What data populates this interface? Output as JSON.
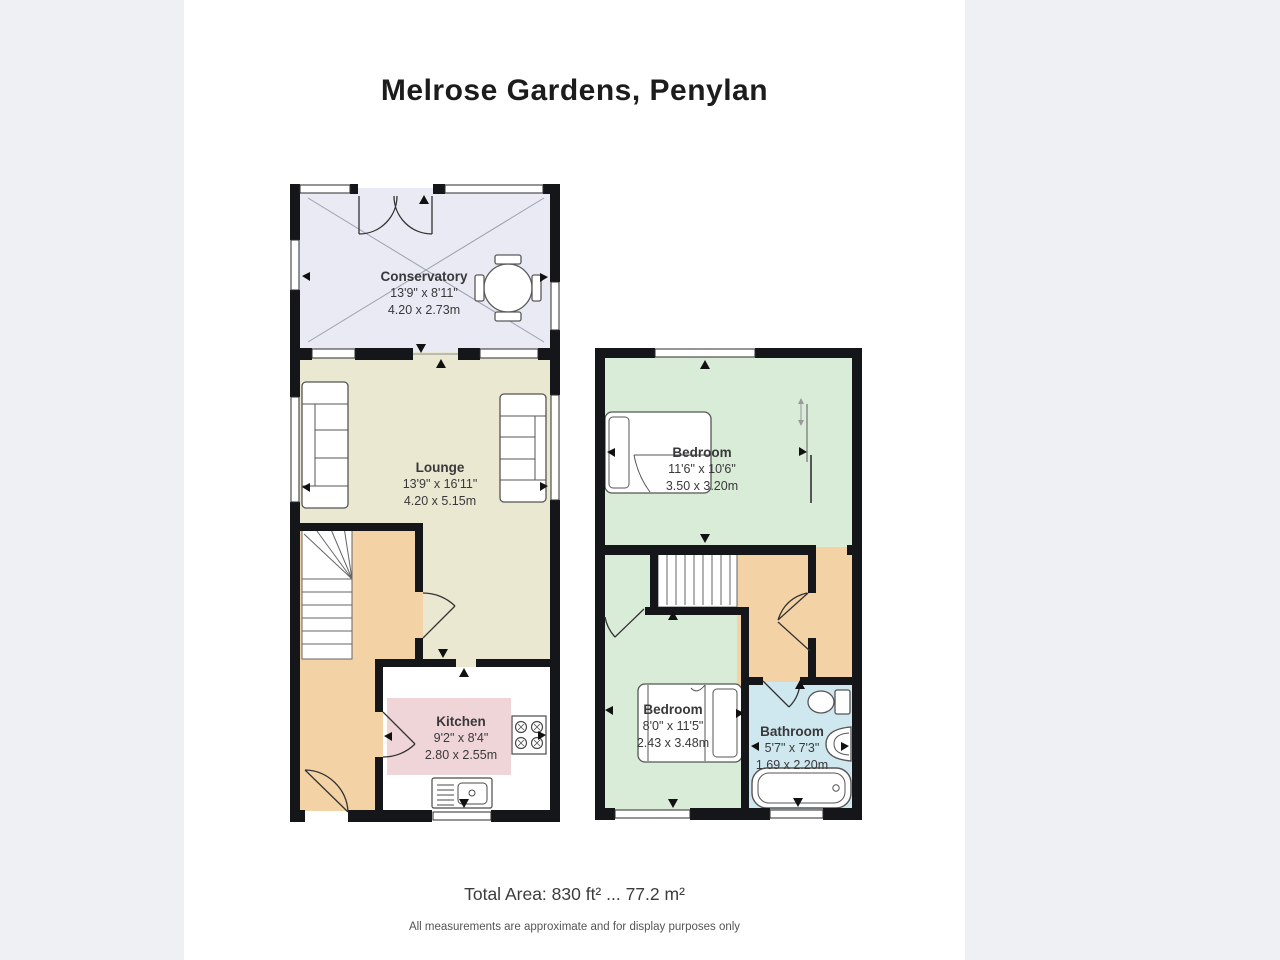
{
  "title": "Melrose Gardens, Penylan",
  "footer": {
    "total_area": "Total Area: 830 ft² ... 77.2 m²",
    "disclaimer": "All measurements are approximate and for display purposes only"
  },
  "floors": {
    "ground": {
      "rooms": {
        "conservatory": {
          "name": "Conservatory",
          "imperial": "13'9\" x 8'11\"",
          "metric": "4.20 x 2.73m"
        },
        "lounge": {
          "name": "Lounge",
          "imperial": "13'9\" x 16'11\"",
          "metric": "4.20 x 5.15m"
        },
        "kitchen": {
          "name": "Kitchen",
          "imperial": "9'2\" x 8'4\"",
          "metric": "2.80 x 2.55m"
        }
      }
    },
    "first": {
      "rooms": {
        "bedroom1": {
          "name": "Bedroom",
          "imperial": "11'6\" x 10'6\"",
          "metric": "3.50 x 3.20m"
        },
        "bedroom2": {
          "name": "Bedroom",
          "imperial": "8'0\" x 11'5\"",
          "metric": "2.43 x 3.48m"
        },
        "bathroom": {
          "name": "Bathroom",
          "imperial": "5'7\" x 7'3\"",
          "metric": "1.69 x 2.20m"
        }
      }
    }
  },
  "colors": {
    "wall": "#15161a",
    "page_background": "#ffffff",
    "outer_background": "#eef0f4",
    "conservatory_floor": "#e9eaf3",
    "lounge_floor": "#ebe8d2",
    "hall_landing_floor": "#f3d3a5",
    "kitchen_floor": "#ffffff",
    "kitchen_worktop": "#f0d5d8",
    "bedroom_floor": "#d9ecd8",
    "bathroom_floor": "#cfe7ee"
  }
}
